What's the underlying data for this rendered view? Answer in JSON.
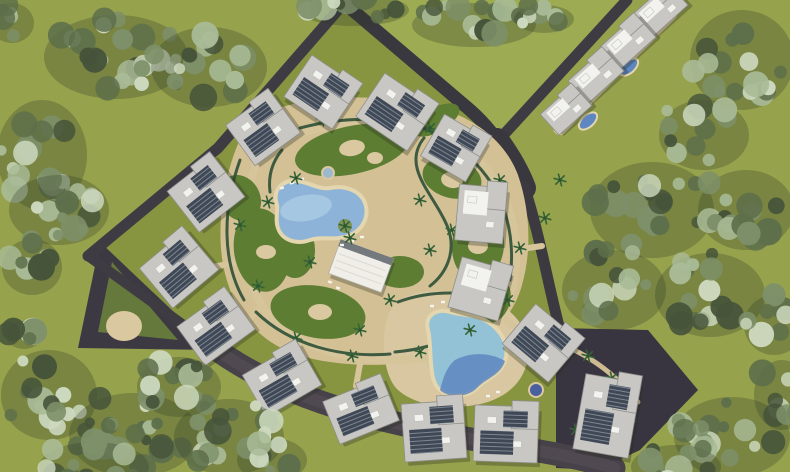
{
  "meta": {
    "description": "Aerial top-down 3D render of a residential resort compound masterplan with apartment buildings, lagoon pools, sandy walkways, perimeter roads and surrounding tree clusters",
    "width": 790,
    "height": 472
  },
  "palette": {
    "grass_outer": "#96a24c",
    "grass_field": "#9dab53",
    "grass_inner": "#879540",
    "lawn": "#5d7d33",
    "sand": "#d3c195",
    "sand_light": "#d9c8a0",
    "pool_rim": "#e4d6ae",
    "pool_main": "#8db4d8",
    "pool_light": "#bad7eb",
    "pool_turquoise": "#93c2d6",
    "pool_deep": "#5e86c0",
    "road_dark": "#3a383f",
    "road_gravel": "#474249",
    "hedge": "#2d4f36",
    "roof_base": "#c8c7c3",
    "roof_edge": "#8f8f8b",
    "roof_white": "#f2f2ee",
    "panel_dark": "#3f4854",
    "panel_stripe": "#7c8794",
    "clubhouse_roof": "#efeee8",
    "tree_palette": [
      "#46543a",
      "#5d6f4b",
      "#7d9069",
      "#a9bb97",
      "#cdd9bf"
    ],
    "tree_shadow": "#2f3b26",
    "palm_green": "#356338",
    "island_green": "#7d9454"
  },
  "scene": {
    "field_polygon": "352,0 622,0 498,136",
    "interior_polygon": "345,3 492,130 524,186 558,330 648,332 698,390 640,450 598,470 450,435 300,400 212,344 88,256 218,148",
    "dark_zones": [
      {
        "name": "west-corner-yard",
        "points": "100,242 78,348 214,350",
        "fill": "#3d3943"
      },
      {
        "name": "west-corner-lawn",
        "points": "112,262 98,332 178,340",
        "fill": "#66793c"
      },
      {
        "name": "southeast-corner-yard",
        "points": "556,328 648,330 698,390 640,450 598,470 556,468",
        "fill": "#393540"
      }
    ],
    "sand_circle": {
      "cx": 124,
      "cy": 326,
      "rx": 18,
      "ry": 15
    },
    "roads": [
      {
        "name": "northwest-boundary-road",
        "d": "M 345,2 L 218,148 L 88,256",
        "w": 11,
        "color": "#3e3b43"
      },
      {
        "name": "southwest-boundary-road",
        "d": "M 88,256 L 210,344",
        "w": 10,
        "color": "#3e3b43"
      },
      {
        "name": "top-entry-road",
        "d": "M 343,2 L 470,110 C 495,132 512,160 524,186",
        "w": 13,
        "color": "#3a383f"
      },
      {
        "name": "northeast-outer-road",
        "d": "M 627,0 L 497,142",
        "w": 11,
        "color": "#3e3b43"
      },
      {
        "name": "junction-pad",
        "d": "M 497,140 C 510,158 518,172 524,188",
        "w": 24,
        "color": "#3a383f"
      },
      {
        "name": "east-boundary-road",
        "d": "M 524,186 C 540,235 548,285 560,330",
        "w": 11,
        "color": "#3c3941"
      },
      {
        "name": "south-gravel-road",
        "d": "M 206,342 C 280,398 360,416 450,435 C 520,449 565,453 614,468",
        "w": 23,
        "color": "#474249"
      },
      {
        "name": "south-gravel-overlay",
        "d": "M 206,342 C 280,398 360,416 450,435 C 520,449 565,453 614,468",
        "w": 12,
        "color": "#575159",
        "opacity": 0.55
      }
    ],
    "sand_areas": [
      {
        "name": "central-park-ground",
        "d": "M 252,118 C 300,96 360,92 420,104 C 470,112 505,140 518,175 C 530,210 532,250 522,285 C 512,322 480,350 440,358 C 395,368 330,368 290,352 C 250,336 228,300 222,258 C 216,214 228,152 252,118 Z",
        "fill": "#d3c195"
      },
      {
        "name": "pool2-deck",
        "d": "M 398,300 C 420,288 455,288 485,298 C 515,308 530,330 528,355 C 526,382 505,400 475,405 C 445,410 415,405 398,390 C 380,374 378,318 398,300 Z",
        "fill": "#d8c7a0"
      }
    ],
    "walkways": [
      {
        "d": "M 670,14 C 640,44 608,76 560,128",
        "w": 14,
        "color": "#d8c7a0"
      },
      {
        "d": "M 262,148 C 240,200 238,262 262,306 C 290,350 360,366 424,358 C 478,350 508,318 515,274 C 521,230 506,180 468,152",
        "w": 8,
        "color": "#d6c59b"
      },
      {
        "d": "M 468,152 C 430,126 370,118 320,128 C 296,133 276,139 262,148",
        "w": 8,
        "color": "#d6c59b"
      },
      {
        "d": "M 238,262 L 208,268",
        "w": 6,
        "color": "#d6c59b"
      },
      {
        "d": "M 262,306 L 246,322",
        "w": 6,
        "color": "#d6c59b"
      },
      {
        "d": "M 300,352 L 292,372",
        "w": 6,
        "color": "#d6c59b"
      },
      {
        "d": "M 360,364 L 356,386",
        "w": 6,
        "color": "#d6c59b"
      },
      {
        "d": "M 428,358 L 436,380",
        "w": 6,
        "color": "#d6c59b"
      },
      {
        "d": "M 506,320 L 528,338",
        "w": 6,
        "color": "#d6c59b"
      },
      {
        "d": "M 514,250 L 542,246",
        "w": 6,
        "color": "#d6c59b"
      },
      {
        "d": "M 470,152 L 474,132",
        "w": 6,
        "color": "#d6c59b"
      },
      {
        "d": "M 340,124 L 336,102",
        "w": 6,
        "color": "#d6c59b"
      },
      {
        "d": "M 264,200 L 240,194",
        "w": 6,
        "color": "#d6c59b"
      },
      {
        "d": "M 570,348 C 600,362 622,382 638,402",
        "w": 5,
        "color": "#cdbb92"
      }
    ],
    "lawns": [
      {
        "cx": 352,
        "cy": 150,
        "rx": 58,
        "ry": 24,
        "rot": -12
      },
      {
        "cx": 452,
        "cy": 178,
        "rx": 30,
        "ry": 20,
        "rot": 15
      },
      {
        "cx": 478,
        "cy": 245,
        "rx": 26,
        "ry": 36,
        "rot": 5
      },
      {
        "cx": 262,
        "cy": 250,
        "rx": 28,
        "ry": 42,
        "rot": -8
      },
      {
        "cx": 318,
        "cy": 312,
        "rx": 48,
        "ry": 26,
        "rot": 10
      },
      {
        "cx": 400,
        "cy": 272,
        "rx": 24,
        "ry": 16,
        "rot": 0
      },
      {
        "cx": 436,
        "cy": 120,
        "rx": 26,
        "ry": 12,
        "rot": -30
      },
      {
        "cx": 240,
        "cy": 198,
        "rx": 20,
        "ry": 24,
        "rot": -30
      },
      {
        "cx": 492,
        "cy": 300,
        "rx": 18,
        "ry": 24,
        "rot": 20
      },
      {
        "cx": 295,
        "cy": 250,
        "rx": 20,
        "ry": 28,
        "rot": 0
      }
    ],
    "lawn_blobs": [
      {
        "cx": 352,
        "cy": 148,
        "rx": 13,
        "ry": 8,
        "rot": -10
      },
      {
        "cx": 375,
        "cy": 158,
        "rx": 8,
        "ry": 6,
        "rot": 0
      },
      {
        "cx": 452,
        "cy": 180,
        "rx": 11,
        "ry": 8,
        "rot": 10
      },
      {
        "cx": 478,
        "cy": 246,
        "rx": 10,
        "ry": 8,
        "rot": 0
      },
      {
        "cx": 320,
        "cy": 312,
        "rx": 12,
        "ry": 8,
        "rot": 0
      },
      {
        "cx": 266,
        "cy": 252,
        "rx": 10,
        "ry": 7,
        "rot": 0
      }
    ],
    "hedges": [
      {
        "d": "M 300,128 C 360,112 420,118 462,148"
      },
      {
        "d": "M 470,158 C 505,190 516,235 510,280"
      },
      {
        "d": "M 505,292 C 480,330 440,348 395,352"
      },
      {
        "d": "M 240,160 C 222,210 222,262 244,300"
      },
      {
        "d": "M 256,312 C 290,345 340,358 390,354"
      },
      {
        "d": "M 424,138 C 400,168 436,196 448,228 C 456,250 448,272 430,286"
      },
      {
        "d": "M 398,302 C 430,290 470,290 500,302"
      },
      {
        "d": "M 282,150 C 272,162 268,176 270,192"
      }
    ],
    "pool_main": {
      "d": "M 277,205 C 272,190 282,180 296,181 C 310,182 318,190 330,188 C 344,185 360,190 365,203 C 370,217 362,231 348,236 C 334,241 322,236 310,240 C 296,245 282,240 278,228 C 275,220 278,212 277,205 Z",
      "fill": "#8db4d8"
    },
    "pool_main_highlight": {
      "cx": 306,
      "cy": 208,
      "rx": 26,
      "ry": 13,
      "rot": -10,
      "fill": "#bad7eb",
      "opacity": 0.55
    },
    "pool_island": {
      "cx": 345,
      "cy": 226,
      "r": 7,
      "fill": "#7d9454"
    },
    "pool_second": {
      "d": "M 428,330 C 424,316 436,308 450,312 C 464,316 476,314 488,322 C 502,331 510,346 505,361 C 500,376 486,378 477,388 C 467,398 448,398 438,388 C 428,378 432,344 428,330 Z",
      "fill": "#93c2d6"
    },
    "pool_second_deep": {
      "d": "M 455,360 C 470,352 490,352 505,361 C 500,376 486,378 477,388 C 467,398 448,398 440,390 C 444,374 448,366 455,360 Z",
      "fill": "#5e86c0",
      "opacity": 0.85
    },
    "ne_pools": [
      {
        "cx": 629,
        "cy": 67,
        "rx": 11,
        "ry": 6,
        "rot": -42
      },
      {
        "cx": 588,
        "cy": 121,
        "rx": 11,
        "ry": 6,
        "rot": -42
      }
    ],
    "spas": [
      {
        "cx": 328,
        "cy": 173,
        "r": 6,
        "fill": "#9db9cf"
      },
      {
        "cx": 536,
        "cy": 390,
        "r": 7,
        "fill": "#4a5f9e"
      }
    ],
    "clubhouse": {
      "cx": 361,
      "cy": 266,
      "w": 56,
      "h": 36,
      "rot": 20
    },
    "loungers": [
      [
        282,
        188,
        -20
      ],
      [
        292,
        183,
        -20
      ],
      [
        302,
        179,
        -20
      ],
      [
        352,
        241,
        0
      ],
      [
        342,
        245,
        0
      ],
      [
        362,
        237,
        0
      ],
      [
        432,
        306,
        0
      ],
      [
        443,
        302,
        0
      ],
      [
        454,
        300,
        0
      ],
      [
        498,
        392,
        0
      ],
      [
        488,
        396,
        0
      ],
      [
        338,
        288,
        20
      ],
      [
        330,
        282,
        20
      ]
    ],
    "palms": [
      [
        296,
        178
      ],
      [
        268,
        202
      ],
      [
        258,
        286
      ],
      [
        296,
        338
      ],
      [
        352,
        356
      ],
      [
        420,
        352
      ],
      [
        470,
        330
      ],
      [
        508,
        300
      ],
      [
        520,
        248
      ],
      [
        500,
        180
      ],
      [
        470,
        160
      ],
      [
        430,
        128
      ],
      [
        370,
        118
      ],
      [
        322,
        120
      ],
      [
        350,
        238
      ],
      [
        390,
        300
      ],
      [
        360,
        330
      ],
      [
        240,
        225
      ],
      [
        430,
        250
      ],
      [
        452,
        230
      ],
      [
        540,
        320
      ],
      [
        420,
        200
      ],
      [
        310,
        262
      ],
      [
        345,
        226
      ],
      [
        610,
        60
      ],
      [
        580,
        95
      ],
      [
        640,
        35
      ],
      [
        588,
        356
      ],
      [
        612,
        378
      ],
      [
        630,
        420
      ],
      [
        576,
        430
      ],
      [
        560,
        180
      ],
      [
        545,
        218
      ]
    ],
    "buildings": [
      {
        "x": 322,
        "y": 92,
        "w": 58,
        "h": 50,
        "r": 34,
        "s": "dark"
      },
      {
        "x": 396,
        "y": 112,
        "w": 62,
        "h": 52,
        "r": 34,
        "s": "dark"
      },
      {
        "x": 455,
        "y": 148,
        "w": 52,
        "h": 48,
        "r": 30,
        "s": "dark"
      },
      {
        "x": 481,
        "y": 214,
        "w": 48,
        "h": 56,
        "r": 5,
        "s": "light"
      },
      {
        "x": 480,
        "y": 289,
        "w": 52,
        "h": 52,
        "r": 16,
        "s": "light"
      },
      {
        "x": 542,
        "y": 343,
        "w": 60,
        "h": 52,
        "r": 40,
        "s": "dark"
      },
      {
        "x": 607,
        "y": 416,
        "w": 56,
        "h": 76,
        "r": 10,
        "s": "dark"
      },
      {
        "x": 506,
        "y": 434,
        "w": 64,
        "h": 56,
        "r": 2,
        "s": "dark"
      },
      {
        "x": 434,
        "y": 431,
        "w": 62,
        "h": 58,
        "r": -4,
        "s": "dark"
      },
      {
        "x": 361,
        "y": 411,
        "w": 64,
        "h": 46,
        "r": -22,
        "s": "dark"
      },
      {
        "x": 282,
        "y": 380,
        "w": 64,
        "h": 48,
        "r": -30,
        "s": "dark"
      },
      {
        "x": 216,
        "y": 328,
        "w": 62,
        "h": 48,
        "r": -36,
        "s": "dark"
      },
      {
        "x": 179,
        "y": 269,
        "w": 60,
        "h": 52,
        "r": -40,
        "s": "dark"
      },
      {
        "x": 206,
        "y": 194,
        "w": 58,
        "h": 52,
        "r": -38,
        "s": "dark"
      },
      {
        "x": 263,
        "y": 129,
        "w": 56,
        "h": 50,
        "r": -36,
        "s": "dark"
      },
      {
        "x": 660,
        "y": 10,
        "w": 48,
        "h": 30,
        "r": -42,
        "s": "light"
      },
      {
        "x": 628,
        "y": 42,
        "w": 48,
        "h": 30,
        "r": -42,
        "s": "light"
      },
      {
        "x": 596,
        "y": 76,
        "w": 48,
        "h": 30,
        "r": -42,
        "s": "light"
      },
      {
        "x": 566,
        "y": 110,
        "w": 44,
        "h": 28,
        "r": -42,
        "s": "light"
      }
    ],
    "tree_clusters": [
      {
        "cx": 112,
        "cy": 52,
        "rx": 72,
        "ry": 42,
        "n": 24
      },
      {
        "cx": 205,
        "cy": 62,
        "rx": 58,
        "ry": 40,
        "n": 18
      },
      {
        "cx": 38,
        "cy": 150,
        "rx": 45,
        "ry": 55,
        "n": 16
      },
      {
        "cx": 55,
        "cy": 205,
        "rx": 50,
        "ry": 35,
        "n": 12
      },
      {
        "cx": 28,
        "cy": 262,
        "rx": 30,
        "ry": 28,
        "n": 8
      },
      {
        "cx": 470,
        "cy": 20,
        "rx": 62,
        "ry": 22,
        "n": 14
      },
      {
        "cx": 540,
        "cy": 14,
        "rx": 30,
        "ry": 14,
        "n": 7
      },
      {
        "cx": 738,
        "cy": 55,
        "rx": 52,
        "ry": 50,
        "n": 16
      },
      {
        "cx": 700,
        "cy": 130,
        "rx": 45,
        "ry": 35,
        "n": 12
      },
      {
        "cx": 648,
        "cy": 205,
        "rx": 62,
        "ry": 48,
        "n": 18
      },
      {
        "cx": 742,
        "cy": 205,
        "rx": 48,
        "ry": 40,
        "n": 14
      },
      {
        "cx": 610,
        "cy": 285,
        "rx": 52,
        "ry": 40,
        "n": 14
      },
      {
        "cx": 706,
        "cy": 290,
        "rx": 55,
        "ry": 42,
        "n": 16
      },
      {
        "cx": 770,
        "cy": 320,
        "rx": 30,
        "ry": 30,
        "n": 8
      },
      {
        "cx": 45,
        "cy": 390,
        "rx": 48,
        "ry": 45,
        "n": 16
      },
      {
        "cx": 130,
        "cy": 430,
        "rx": 65,
        "ry": 42,
        "n": 20
      },
      {
        "cx": 225,
        "cy": 432,
        "rx": 55,
        "ry": 38,
        "n": 16
      },
      {
        "cx": 90,
        "cy": 462,
        "rx": 55,
        "ry": 25,
        "n": 12
      },
      {
        "cx": 175,
        "cy": 382,
        "rx": 42,
        "ry": 30,
        "n": 12
      },
      {
        "cx": 268,
        "cy": 455,
        "rx": 35,
        "ry": 22,
        "n": 9
      },
      {
        "cx": 728,
        "cy": 432,
        "rx": 58,
        "ry": 40,
        "n": 16
      },
      {
        "cx": 672,
        "cy": 462,
        "rx": 45,
        "ry": 22,
        "n": 10
      },
      {
        "cx": 778,
        "cy": 390,
        "rx": 28,
        "ry": 35,
        "n": 8
      },
      {
        "cx": 8,
        "cy": 18,
        "rx": 22,
        "ry": 20,
        "n": 6
      },
      {
        "cx": 350,
        "cy": 5,
        "rx": 55,
        "ry": 16,
        "n": 10
      },
      {
        "cx": 20,
        "cy": 330,
        "rx": 18,
        "ry": 14,
        "n": 5
      }
    ]
  }
}
